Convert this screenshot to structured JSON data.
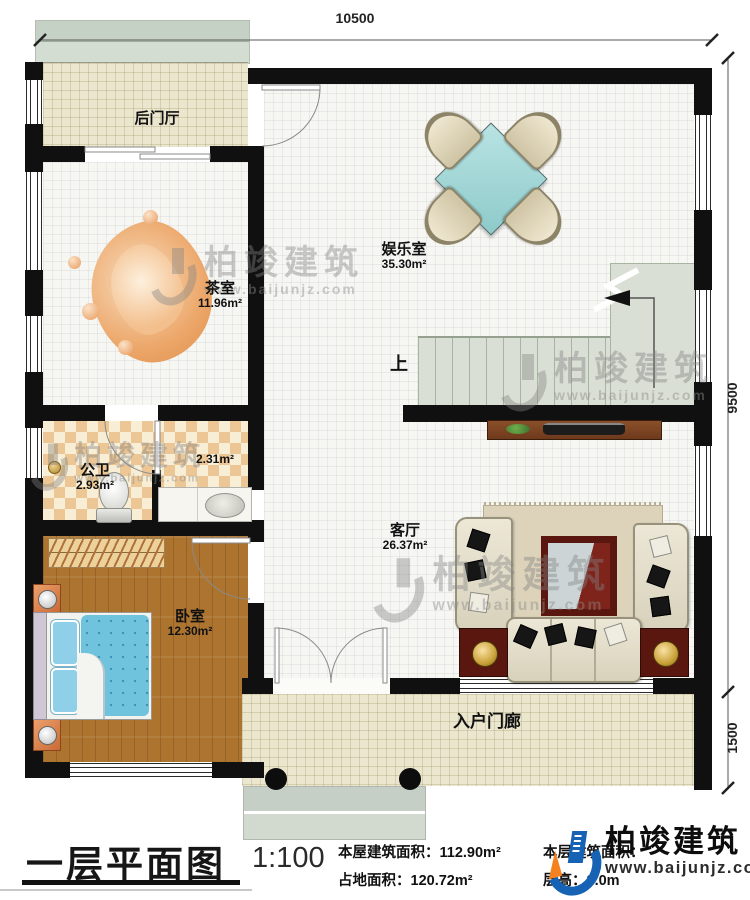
{
  "brand": {
    "name": "柏竣建筑",
    "website": "www.baijunjz.com"
  },
  "title_block": {
    "title": "一层平面图",
    "scale": "1:100",
    "stats_left": [
      {
        "label": "本屋建筑面积：",
        "value": "112.90m²"
      },
      {
        "label": "占地面积：",
        "value": "120.72m²"
      }
    ],
    "stats_right": [
      {
        "label": "本层建筑面积：",
        "value": ""
      },
      {
        "label": "层高：",
        "value": "3.0m"
      }
    ]
  },
  "dimensions": {
    "top": "10500",
    "side_upper": "9500",
    "side_lower": "1500"
  },
  "rooms": {
    "back_hall": {
      "name": "后门厅"
    },
    "tea_room": {
      "name": "茶室",
      "area": "11.96m²"
    },
    "entertainment": {
      "name": "娱乐室",
      "area": "35.30m²"
    },
    "bathroom": {
      "name": "公卫",
      "area": "2.93m²"
    },
    "washroom": {
      "area": "2.31m²"
    },
    "bedroom": {
      "name": "卧室",
      "area": "12.30m²"
    },
    "living_room": {
      "name": "客厅",
      "area": "26.37m²"
    },
    "porch": {
      "name": "入户门廊"
    }
  },
  "stairs": {
    "up_label": "上"
  }
}
